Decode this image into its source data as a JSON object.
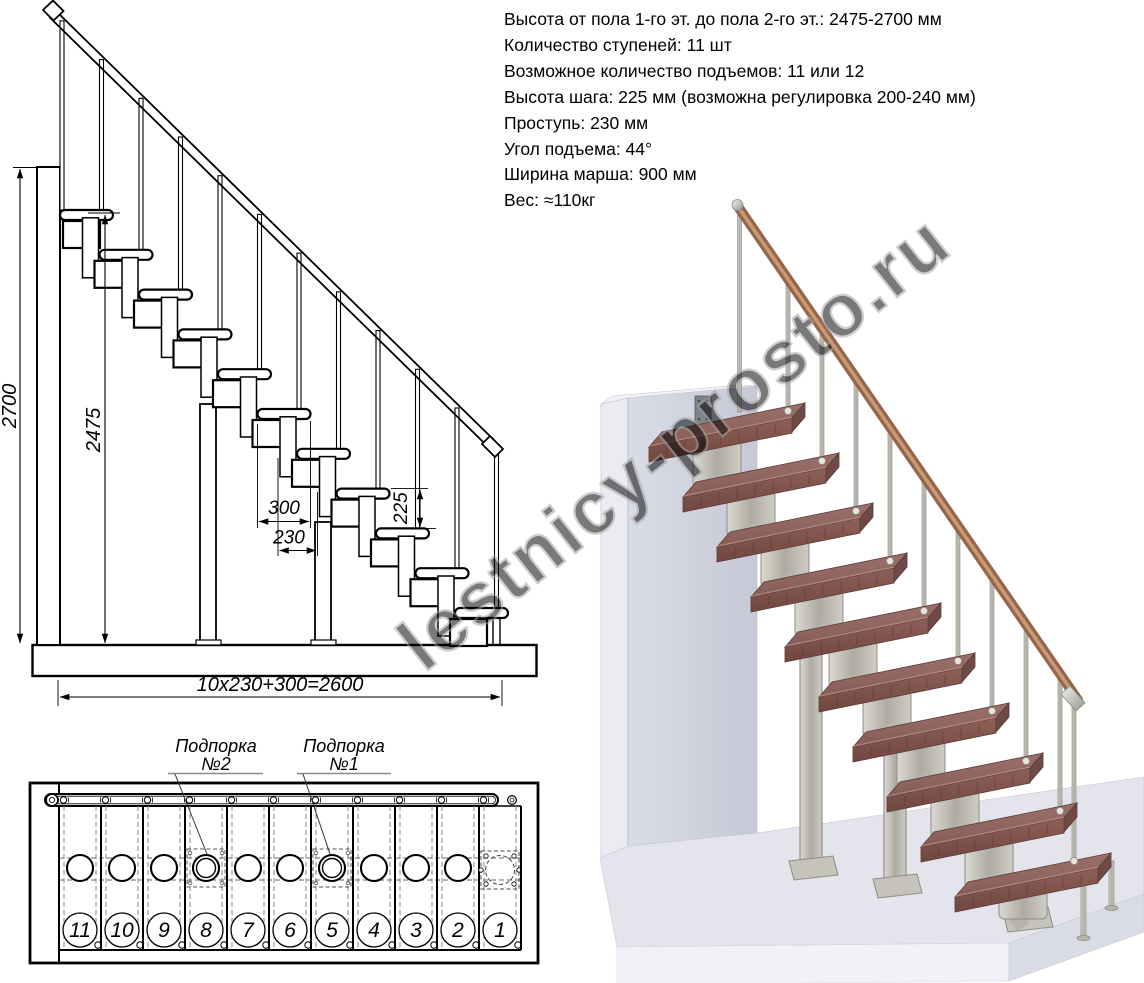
{
  "specs": {
    "lines": [
      "Высота от пола 1-го эт. до пола 2-го эт.: 2475-2700 мм",
      "Количество ступеней: 11 шт",
      "Возможное количество подъемов: 11 или 12",
      "Высота шага: 225 мм (возможна регулировка 200-240 мм)",
      "Проступь: 230 мм",
      "Угол подъема: 44°",
      "Ширина марша: 900 мм",
      "Вес: ≈110кг"
    ]
  },
  "elevation": {
    "height_total": "2700",
    "height_stair": "2475",
    "tread_depth": "300",
    "step_run": "230",
    "step_rise": "225",
    "total_run": "10x230+300=2600"
  },
  "plan": {
    "steps": [
      "11",
      "10",
      "9",
      "8",
      "7",
      "6",
      "5",
      "4",
      "3",
      "2",
      "1"
    ],
    "support2": {
      "line1": "Подпорка",
      "line2": "№2"
    },
    "support1": {
      "line1": "Подпорка",
      "line2": "№1"
    }
  },
  "watermark": "lestnicy-prosto.ru",
  "render3d": {
    "tread_count": 10,
    "colors": {
      "tread_top": "#916864",
      "tread_front": "#84584f",
      "metal": "#bdbab1",
      "handrail": "#96654a",
      "wall": "#d2d4de",
      "floor": "#e3e4ec"
    }
  }
}
